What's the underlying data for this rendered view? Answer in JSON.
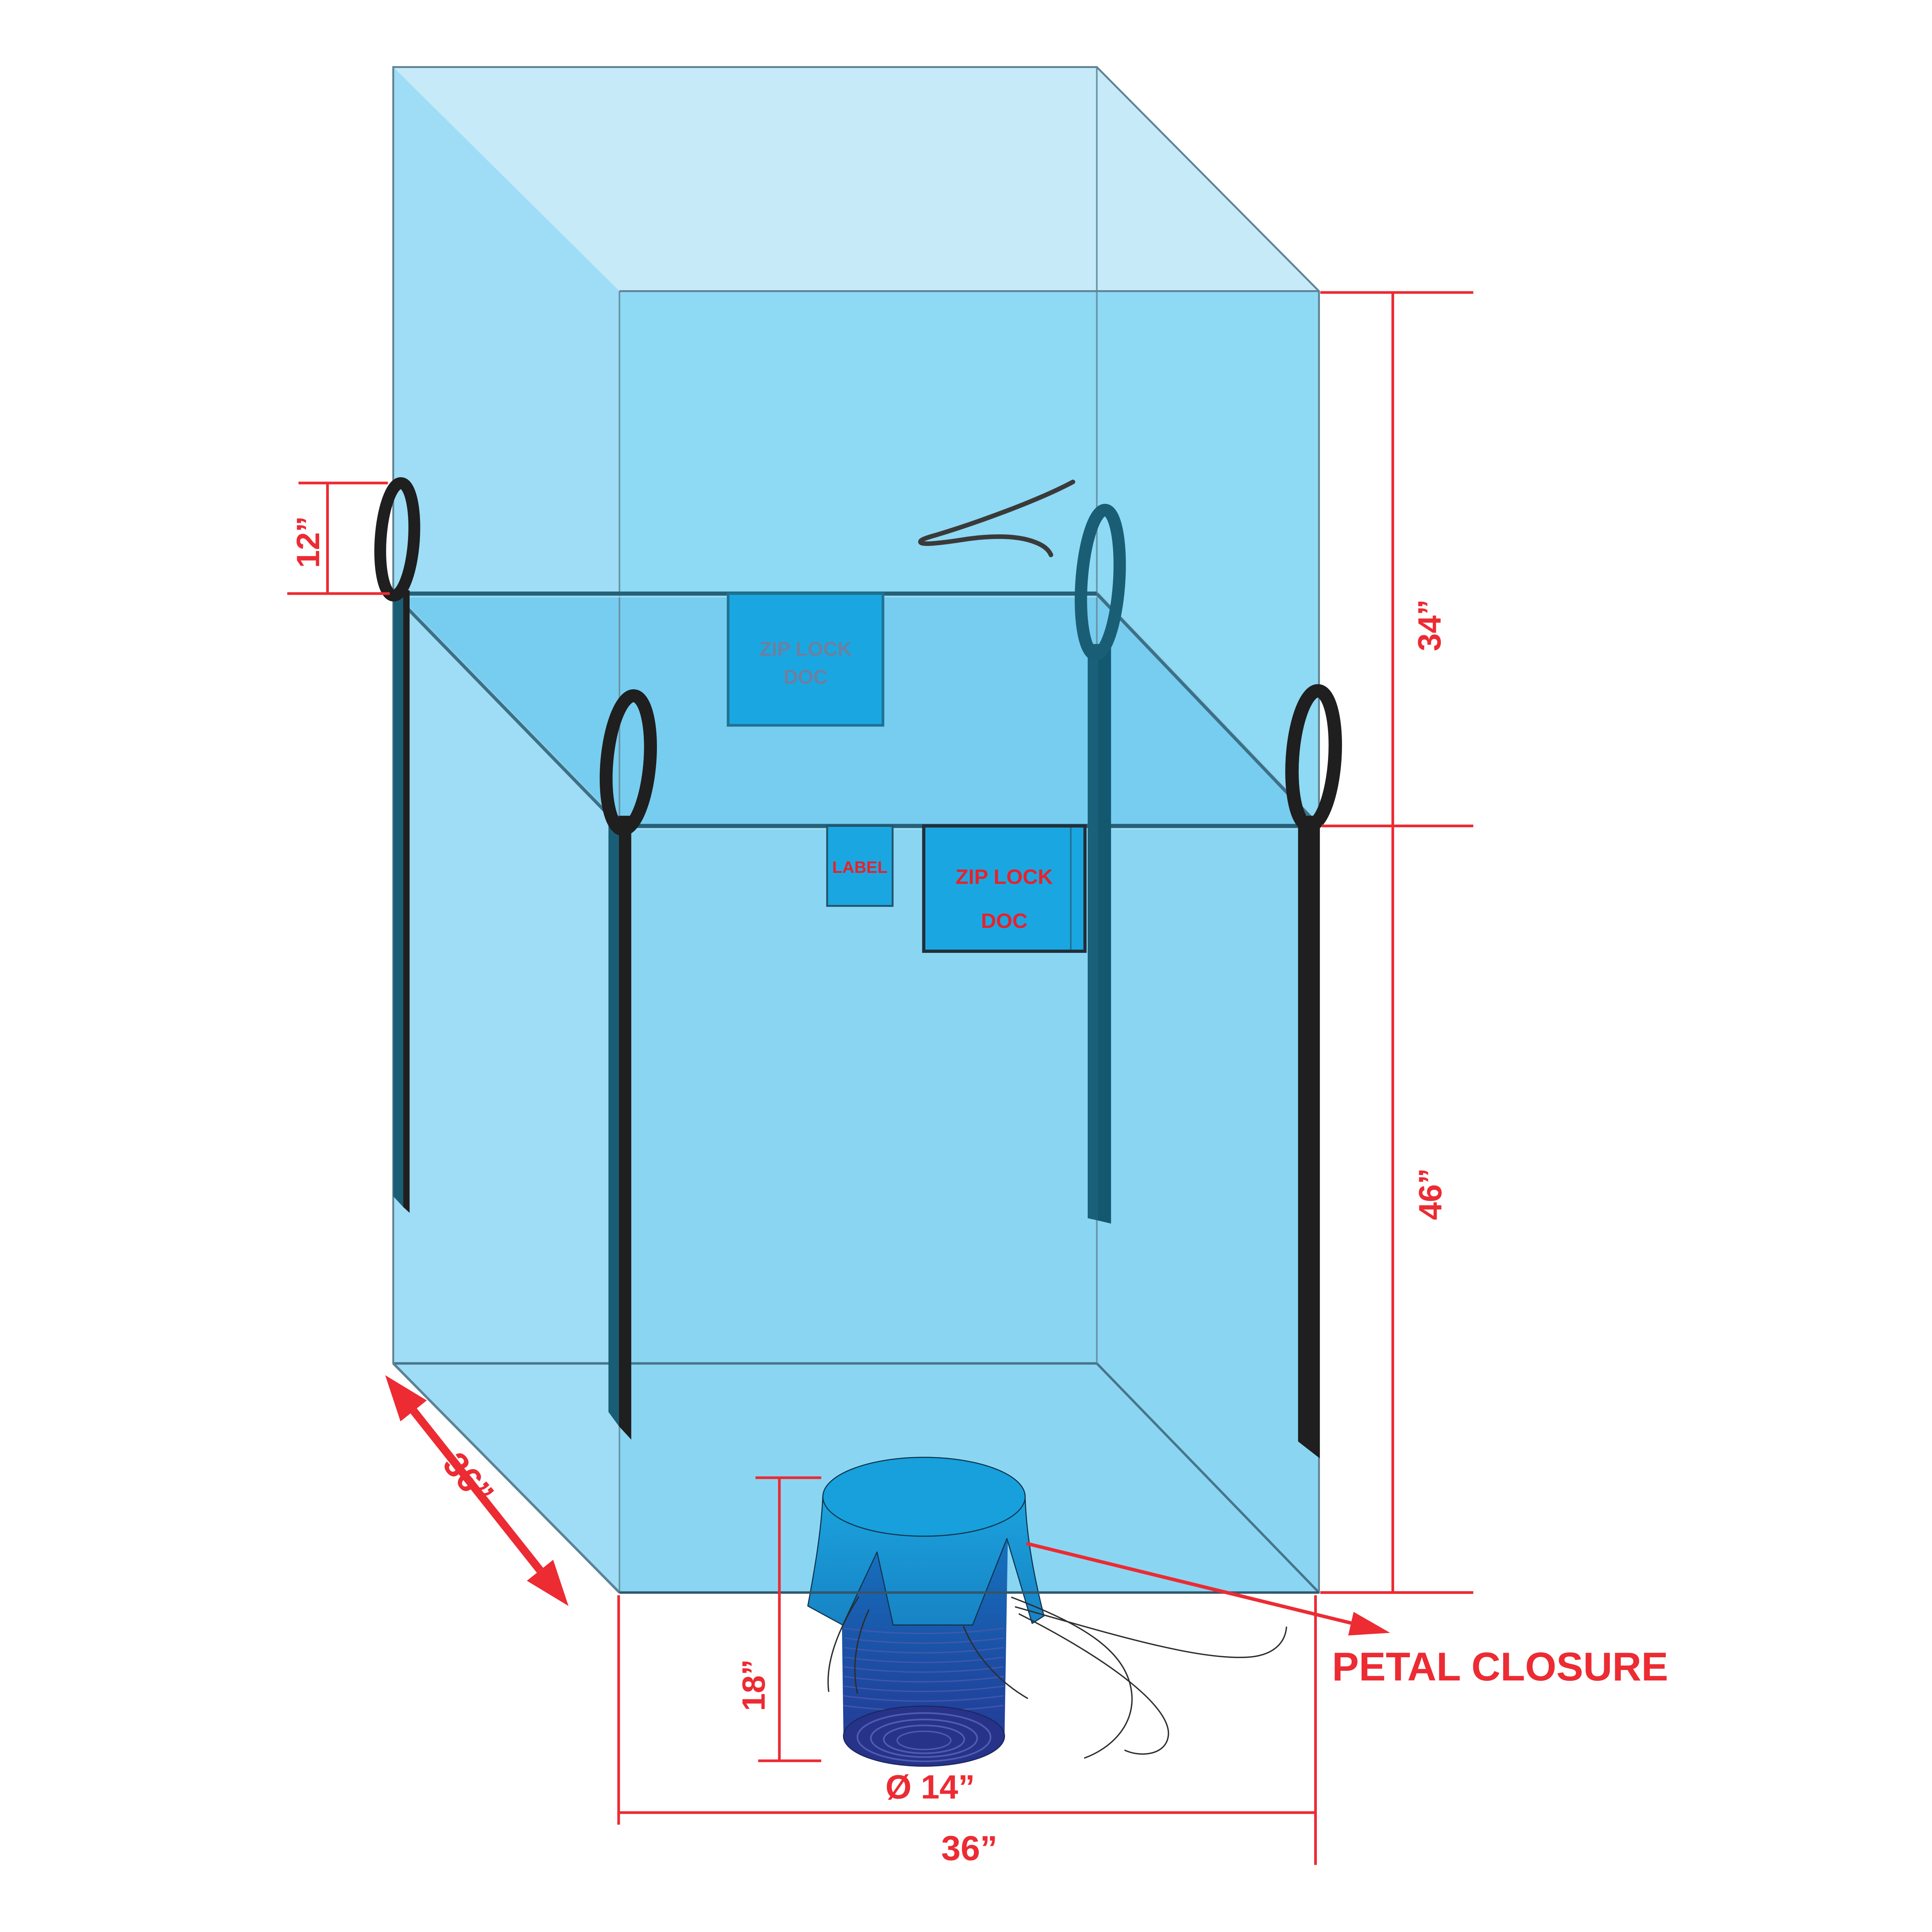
{
  "document": {
    "type": "technical-drawing",
    "subject": "bulk-bag-with-discharge-spout"
  },
  "labels": {
    "dim_loop_height": "12”",
    "dim_top_height": "34”",
    "dim_body_height": "46”",
    "dim_base_depth": "36”",
    "dim_spout_length": "18”",
    "dim_spout_diameter": "Ø 14”",
    "dim_base_width": "36”",
    "callout_petal_closure": "PETAL CLOSURE",
    "pocket_zip_top_line1": "ZIP LOCK",
    "pocket_zip_top_line2": "DOC",
    "pocket_label": "LABEL",
    "pocket_zip_front_line1": "ZIP LOCK",
    "pocket_zip_front_line2": "DOC"
  },
  "colors": {
    "dimension_red": "#EC2B33",
    "bag_front": "#8ED9F3",
    "bag_left_face": "#9EDDF5",
    "bag_top_face": "#C7EAF8",
    "bag_rim_band": "#76CDEF",
    "bag_body": "#8AD6F2",
    "pocket_blue": "#1AA7E1",
    "seam_dark": "#266077",
    "loop_black": "#1F1F1F",
    "loop_teal": "#1A5E76",
    "spout_blue": "#17A0DC",
    "spout_navy": "#283593",
    "zip_top_text": "#6E7FA0",
    "tie_string": "#3A3A3A"
  }
}
